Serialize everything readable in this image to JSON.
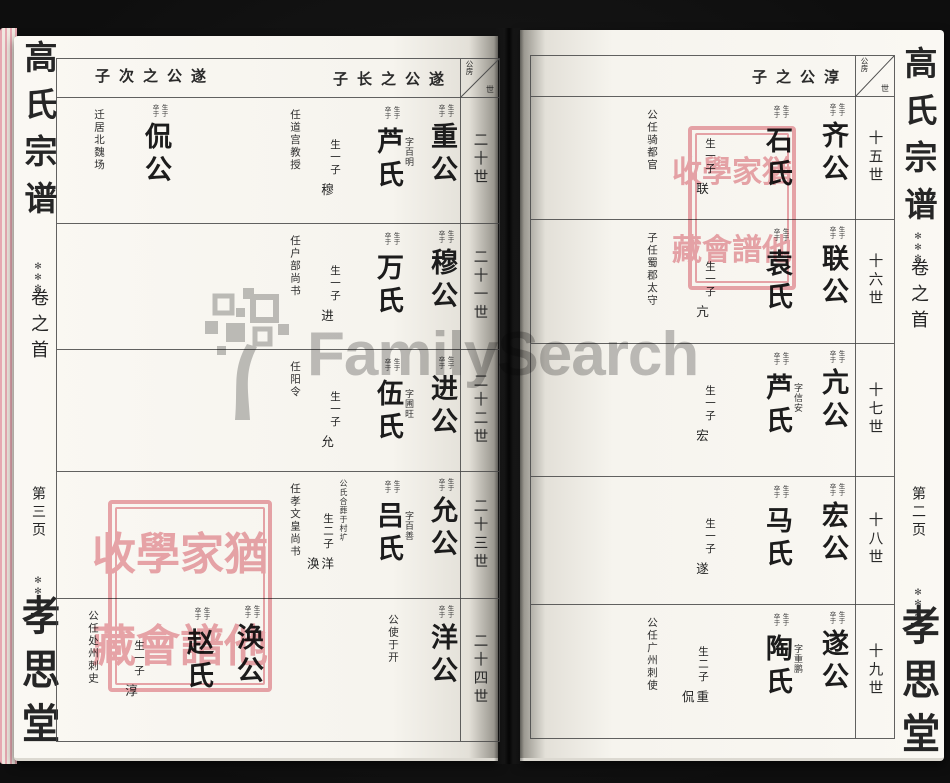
{
  "watermark": {
    "text": "FamilySearch"
  },
  "labels": {
    "born": "生于",
    "died": "卒于"
  },
  "seal": {
    "text": "猶他家譜學會收藏"
  },
  "corner": {
    "branch": "公房",
    "gen": "世"
  },
  "left_margin": {
    "title": "高氏宗谱",
    "ornament": "✻✻✻",
    "volume": "卷之首",
    "page": "第三页",
    "hall": "孝思堂"
  },
  "right_margin": {
    "title": "高氏宗谱",
    "ornament": "✻✻✻",
    "volume": "卷之首",
    "page": "第二页",
    "hall": "孝思堂"
  },
  "right_page": {
    "header": "子之公淳",
    "rows": [
      {
        "generation": "十五世",
        "husband": "齐公",
        "wife": "石氏",
        "sons": "生一子",
        "sons_names": "联",
        "office": "公任骑都官"
      },
      {
        "generation": "十六世",
        "husband": "联公",
        "wife": "袁氏",
        "sons": "生一子",
        "sons_names": "亢",
        "office": "子任蜀郡太守"
      },
      {
        "generation": "十七世",
        "husband": "亢公",
        "courtesy": "字信安",
        "wife": "芦氏",
        "sons": "生一子",
        "sons_names": "宏"
      },
      {
        "generation": "十八世",
        "husband": "宏公",
        "wife": "马氏",
        "sons": "生一子",
        "sons_names": "遂"
      },
      {
        "generation": "十九世",
        "husband": "遂公",
        "courtesy": "字重鹏",
        "wife": "陶氏",
        "sons": "生二子",
        "sons_names": "侃重",
        "office": "公任广州刺使"
      }
    ]
  },
  "left_page": {
    "header_long": "子长之公遂",
    "header_second": "子次之公遂",
    "rows": [
      {
        "generation": "二十世",
        "husband": "重公",
        "courtesy": "字百明",
        "wife": "芦氏",
        "sons": "生一子",
        "sons_names": "穆",
        "office": "任道宫教授",
        "second": {
          "husband": "侃公",
          "office": "迁居北魏场"
        }
      },
      {
        "generation": "二十一世",
        "husband": "穆公",
        "wife": "万氏",
        "sons": "生一子",
        "sons_names": "进",
        "office": "任户部尚书"
      },
      {
        "generation": "二十二世",
        "husband": "进公",
        "courtesy": "字圃旺",
        "wife": "伍氏",
        "sons": "生一子",
        "sons_names": "允",
        "office": "任阳令"
      },
      {
        "generation": "二十三世",
        "husband": "允公",
        "courtesy": "字百善",
        "wife": "吕氏",
        "sons": "生二子",
        "sons_names": "涣洋",
        "office": "任孝文皇尚书",
        "burial": "公氏合葬于村圹"
      },
      {
        "generation": "二十四世",
        "husband": "涣公",
        "wife": "赵氏",
        "sons": "生一子",
        "sons_names": "淳",
        "office": "公任处州刺史",
        "second": {
          "husband": "洋公",
          "office": "公使于开"
        }
      }
    ]
  }
}
